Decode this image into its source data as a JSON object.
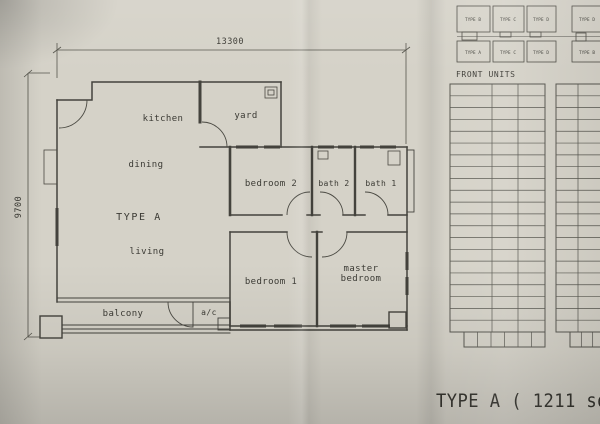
{
  "photo": {
    "paper_color": "#d5d2c8",
    "line_color": "#45443e",
    "text_color": "#3b3a34"
  },
  "dimensions": {
    "top": "13300",
    "left": "9700"
  },
  "plan": {
    "type_label": "TYPE A",
    "rooms": {
      "kitchen": "kitchen",
      "yard": "yard",
      "dining": "dining",
      "living": "living",
      "bedroom2": "bedroom 2",
      "bath2": "bath 2",
      "bath1": "bath 1",
      "bedroom1": "bedroom 1",
      "master_line1": "master",
      "master_line2": "bedroom",
      "balcony": "balcony",
      "ac": "a/c"
    }
  },
  "key_plan": {
    "title": "FRONT UNITS",
    "top_row": [
      "TYPE B",
      "TYPE C",
      "TYPE D",
      "TYPE D"
    ],
    "bottom_row": [
      "TYPE A",
      "TYPE C",
      "TYPE D",
      "TYPE B"
    ]
  },
  "stack_grid": {
    "rows": 21,
    "left_columns": 3,
    "right_columns_visible": 2,
    "left_bottom_cells": 6,
    "right_bottom_cells": 3
  },
  "footer": {
    "caption": "TYPE A ( 1211 sq"
  }
}
